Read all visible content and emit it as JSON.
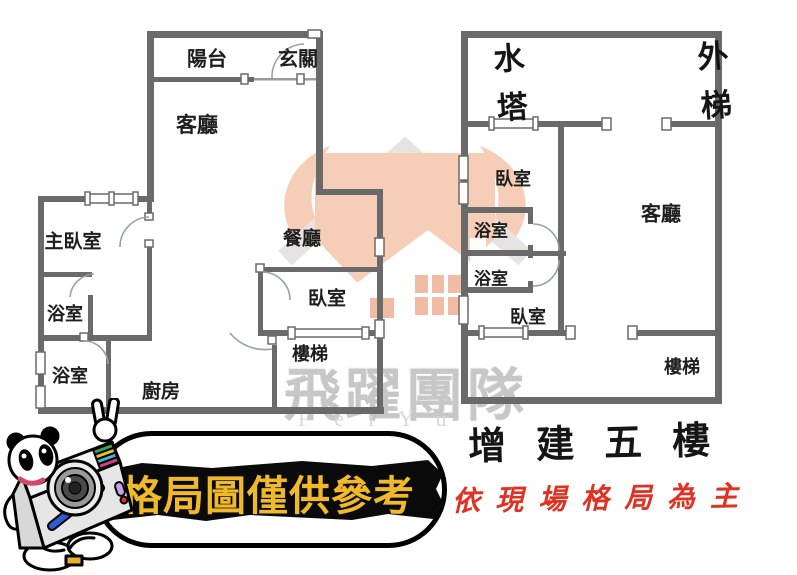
{
  "floor_plan_left": {
    "rooms": {
      "balcony": "陽台",
      "entry": "玄關",
      "living_room": "客廳",
      "master_bedroom": "主臥室",
      "dining_room": "餐廳",
      "bathroom_upper": "浴室",
      "bedroom": "臥室",
      "stairs": "樓梯",
      "bathroom_lower": "浴室",
      "kitchen": "廚房"
    }
  },
  "floor_plan_right": {
    "handwritten": {
      "water_tower": "水塔",
      "external_stairs": "外梯"
    },
    "rooms": {
      "bedroom_upper": "臥室",
      "living_room": "客廳",
      "bathroom_upper": "浴室",
      "bathroom_lower": "浴室",
      "bedroom_lower": "臥室",
      "stairs": "樓梯"
    },
    "caption": "增建五樓"
  },
  "disclaimer": {
    "banner_text": "格局圖僅供參考",
    "banner_text_color": "#efb92b",
    "handwritten_note": "依現場格局為主",
    "note_color": "#df3222"
  },
  "watermark": {
    "team_name": "飛躍團隊",
    "latin_name": "FeiYu",
    "emblem": "feiyu-house-logo",
    "accent_color": "#f6cdb6"
  },
  "mascot": "panda-camera-mascot",
  "colors": {
    "wall": "#6a6a6a",
    "background": "#ffffff"
  }
}
